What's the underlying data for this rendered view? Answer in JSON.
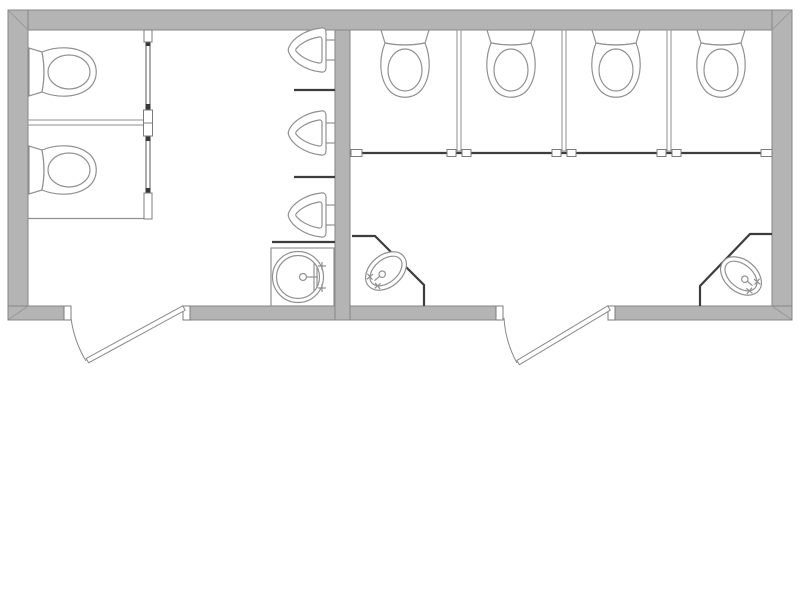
{
  "plan": {
    "type": "restroom-floor-plan",
    "rooms": [
      {
        "id": "left-restroom",
        "fixtures": {
          "toilet_stalls": 2,
          "urinals": 3,
          "urinal_privacy_screens": 2,
          "vanity_sinks": 1,
          "entry_doors": 1
        }
      },
      {
        "id": "right-restroom",
        "fixtures": {
          "toilet_stalls": 4,
          "corner_sinks": 2,
          "entry_doors": 1
        }
      }
    ],
    "totals": {
      "toilets": 6,
      "urinals": 3,
      "sinks": 3,
      "doors": 2
    }
  },
  "colors": {
    "background": "#ffffff",
    "wall_fill": "#b4b4b4",
    "wall_edge": "#868686",
    "fixture_line": "#919191",
    "dark_line": "#3d3d3d",
    "thin_wall_edge": "#8f8f8f",
    "door_line": "#8a8a8a"
  }
}
